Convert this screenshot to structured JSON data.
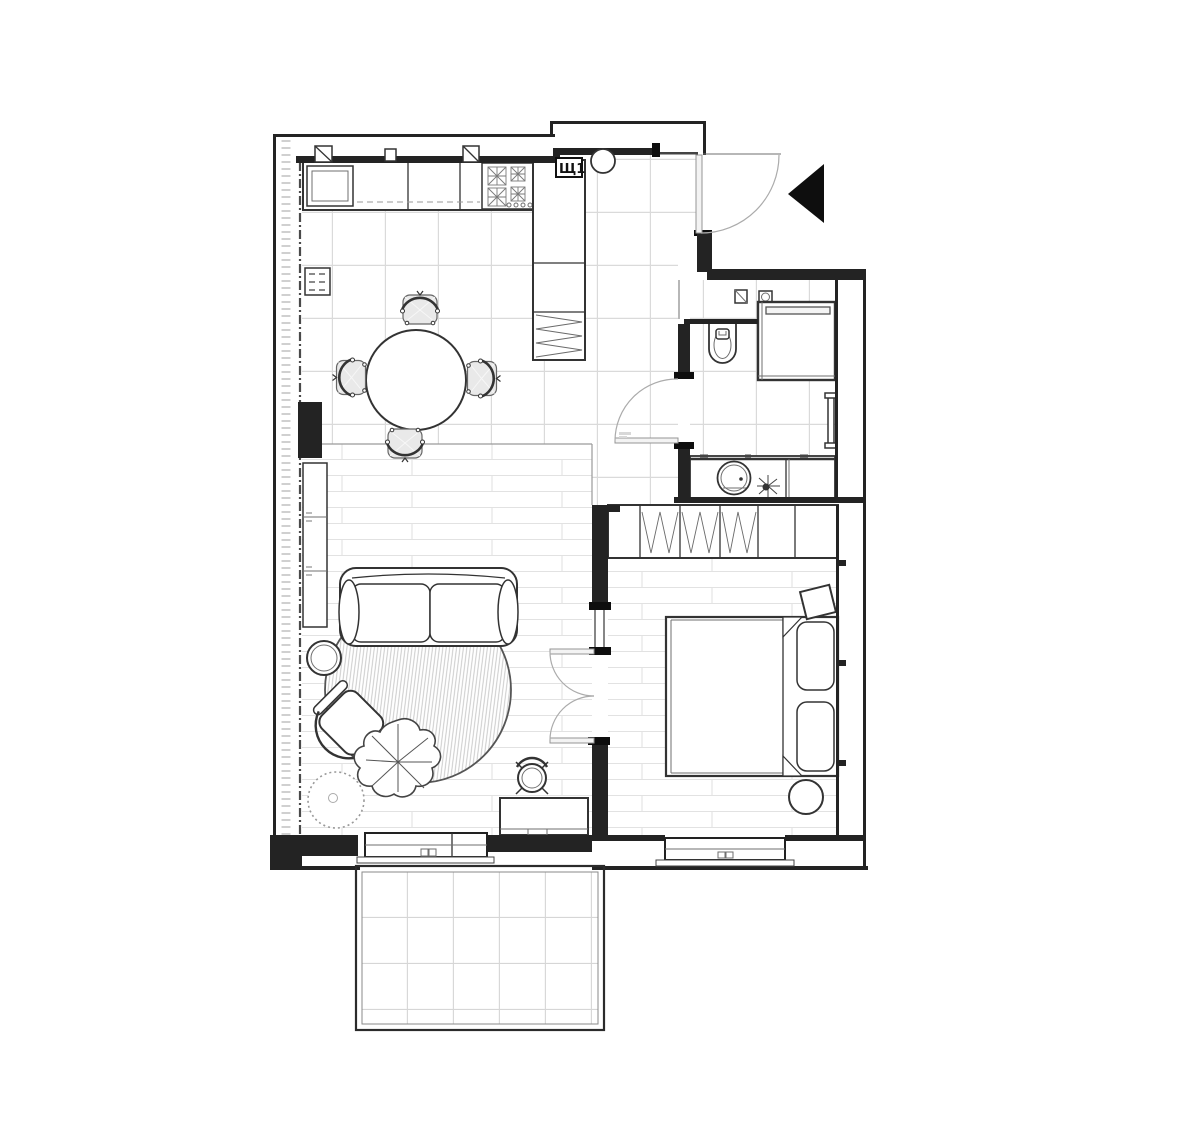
{
  "page": {
    "type": "architectural-floor-plan",
    "background": "#ffffff"
  },
  "labels": {
    "electrical_panel": "Щ1"
  },
  "colors": {
    "wall": "#232323",
    "line": "#333333",
    "tile_grid": "#dadada",
    "plank_line": "#e2e2e2",
    "cushion": "#e9e9e9",
    "door_arc": "#ababab",
    "entry_marker": "#0e0e0e",
    "rug_hatch": "#c6c6c6"
  },
  "rooms": [
    {
      "name": "kitchen-dining",
      "floor": "ceramic-tile",
      "items": [
        "kitchen-counter",
        "kitchen-sink",
        "cooktop-4-burner",
        "tall-cabinet-column",
        "coat-closet-hanging",
        "dining-table-round",
        "dining-chair-top",
        "dining-chair-right",
        "dining-chair-bottom",
        "dining-chair-left",
        "wall-radiator",
        "wall-vent-1",
        "wall-vent-2",
        "wall-vent-3",
        "electrical-panel-box"
      ]
    },
    {
      "name": "entry-hall",
      "floor": "ceramic-tile",
      "items": [
        "entry-door",
        "entry-door-swing",
        "ceiling-light",
        "entry-direction-arrow"
      ]
    },
    {
      "name": "bathroom",
      "floor": "ceramic-tile",
      "items": [
        "toilet",
        "shower-enclosure",
        "shower-bar",
        "towel-radiator",
        "vanity-counter",
        "round-basin",
        "bathroom-plant",
        "vent-duct",
        "water-heater",
        "bathroom-door",
        "bathroom-door-swing"
      ]
    },
    {
      "name": "living-room",
      "floor": "wood-plank",
      "items": [
        "sideboard",
        "sofa-two-seat",
        "round-rug",
        "armchair",
        "monstera-plant",
        "potted-plant",
        "side-table",
        "desk",
        "stool",
        "balcony-window",
        "double-door-to-bedroom"
      ]
    },
    {
      "name": "bedroom",
      "floor": "wood-plank",
      "items": [
        "wardrobe-hanging",
        "double-bed",
        "pillow-1",
        "pillow-2",
        "nightstand-tilted",
        "pouf-round",
        "bedroom-window"
      ]
    },
    {
      "name": "balcony",
      "floor": "tile",
      "items": [
        "railing"
      ]
    }
  ]
}
